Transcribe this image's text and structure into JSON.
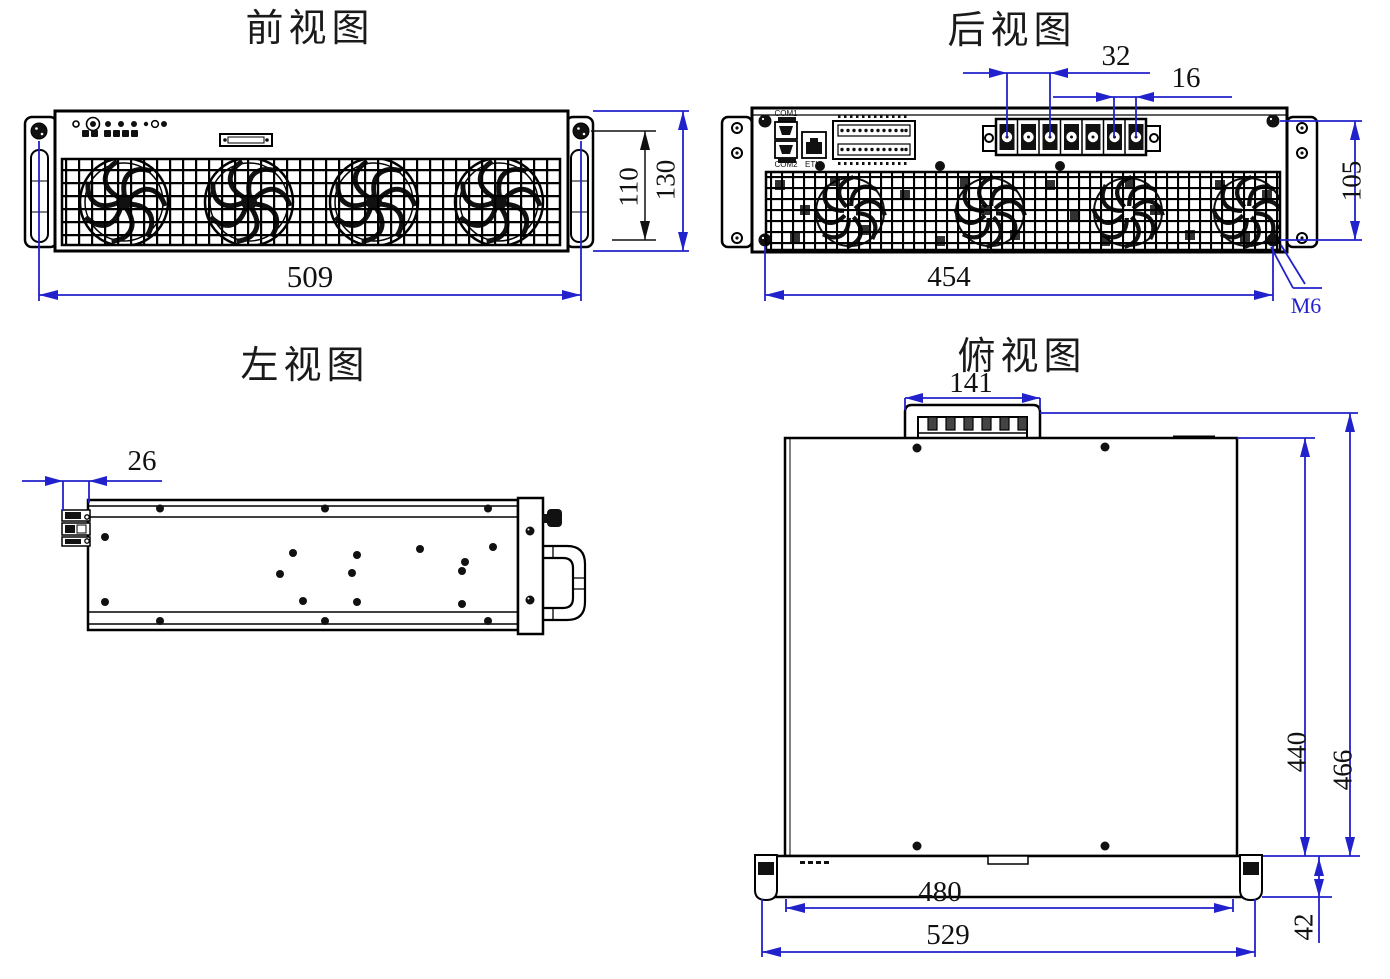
{
  "drawing": {
    "background": "#ffffff",
    "line_color": "#000000",
    "dimension_color": "#2222cc",
    "views": {
      "front": {
        "title": "前视图",
        "dimensions": {
          "overall_width": "509",
          "panel_height": "110",
          "overall_height": "130"
        }
      },
      "rear": {
        "title": "后视图",
        "dimensions": {
          "terminal_spacing_wide": "32",
          "terminal_spacing_narrow": "16",
          "mounting_width": "454",
          "mounting_height": "105",
          "screw_spec": "M6"
        },
        "labels": {
          "com1": "COM1",
          "com2": "COM2",
          "eth": "ETH"
        }
      },
      "left": {
        "title": "左视图",
        "dimensions": {
          "connector_protrusion": "26"
        }
      },
      "top": {
        "title": "俯视图",
        "dimensions": {
          "terminal_block_width": "141",
          "body_depth": "440",
          "overall_depth": "466",
          "panel_width": "480",
          "overall_width": "529",
          "front_panel_depth": "42"
        }
      }
    }
  }
}
